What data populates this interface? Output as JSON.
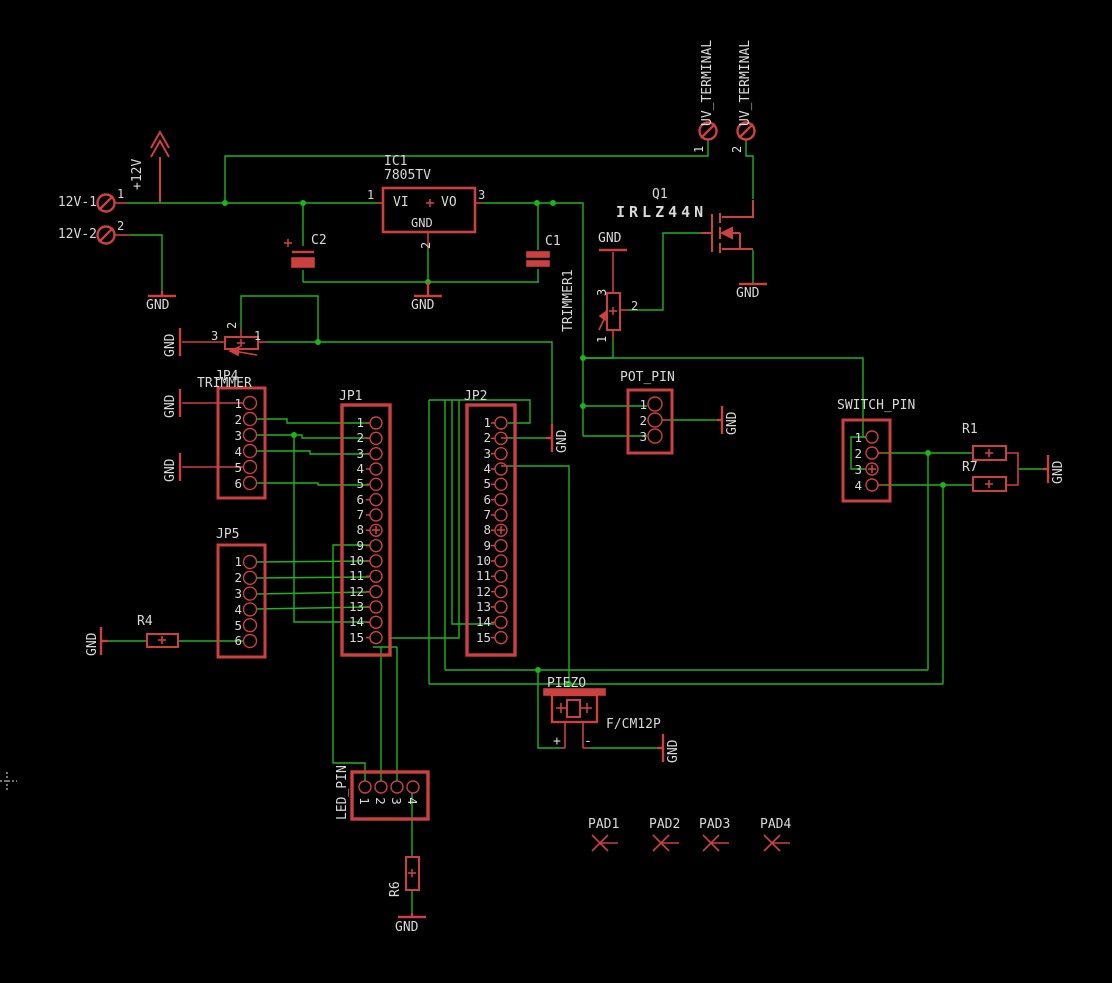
{
  "colors": {
    "bg": "#000000",
    "wire": "#1db31d",
    "part": "#cc4040",
    "text": "#d9d9d9"
  },
  "labels": {
    "gnd": "GND",
    "p12v": "+12V",
    "t12v1": "12V-1",
    "t12v2": "12V-2",
    "ic1": "IC1",
    "ic1_value": "7805TV",
    "vi": "VI",
    "vo": "VO",
    "plus": "+",
    "minus": "-",
    "c1": "C1",
    "c2": "C2",
    "trimmer1": "TRIMMER1",
    "uv_terminal": "UV_TERMINAL",
    "q1": "Q1",
    "q1_value": "IRLZ44N",
    "jp4": "JP4",
    "jp4_value": "TRIMMER",
    "jp1": "JP1",
    "jp2": "JP2",
    "jp5": "JP5",
    "pot": "POT_PIN",
    "switch": "SWITCH_PIN",
    "led": "LED_PIN",
    "piezo": "PIEZO",
    "piezo_value": "F/CM12P",
    "r1": "R1",
    "r7": "R7",
    "r4": "R4",
    "r6": "R6",
    "pad1": "PAD1",
    "pad2": "PAD2",
    "pad3": "PAD3",
    "pad4": "PAD4"
  },
  "pins": {
    "jp1": [
      "1",
      "2",
      "3",
      "4",
      "5",
      "6",
      "7",
      "8",
      "9",
      "10",
      "11",
      "12",
      "13",
      "14",
      "15"
    ],
    "jp2": [
      "1",
      "2",
      "3",
      "4",
      "5",
      "6",
      "7",
      "8",
      "9",
      "10",
      "11",
      "12",
      "13",
      "14",
      "15"
    ],
    "jp4": [
      "1",
      "2",
      "3",
      "4",
      "5",
      "6"
    ],
    "jp5": [
      "1",
      "2",
      "3",
      "4",
      "5",
      "6"
    ],
    "pot": [
      "1",
      "2",
      "3"
    ],
    "switch": [
      "1",
      "2",
      "3",
      "4"
    ],
    "led": [
      "1",
      "2",
      "3",
      "4"
    ],
    "ic": {
      "in": "1",
      "gnd": "2",
      "out": "3"
    },
    "terminals": {
      "t1": "1",
      "t2": "2"
    },
    "uv": {
      "u1": "1",
      "u2": "2"
    },
    "trim_jp4": {
      "a": "3",
      "b": "2",
      "c": "1"
    },
    "trimmer1": {
      "a": "3",
      "b": "2",
      "c": "1"
    }
  }
}
